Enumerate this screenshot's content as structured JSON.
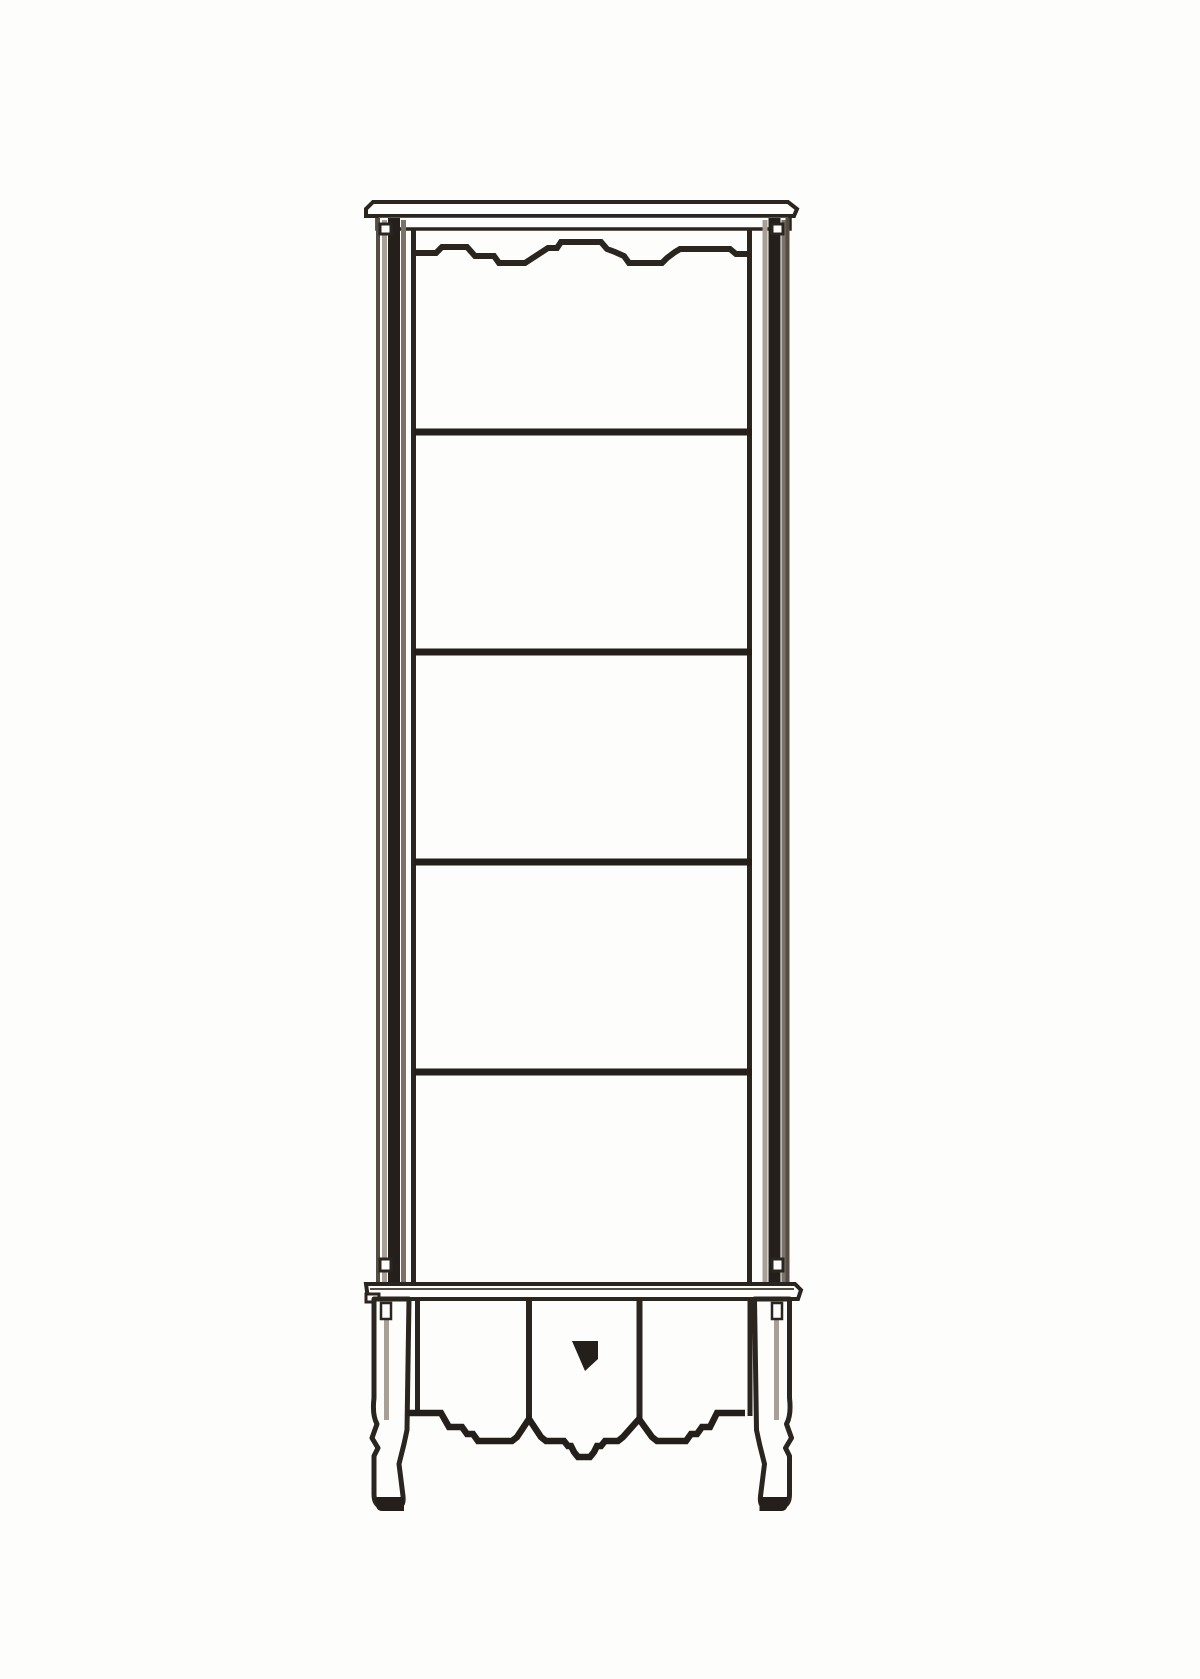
{
  "page": {
    "background": "#fdfdfc",
    "width": 1200,
    "height": 1679
  },
  "figure": {
    "kind": "black-and-white technical line drawing",
    "subject": "Tall narrow display shelf unit with carved top apron, five open shelf compartments, lower drawer apron with center keyhole, and two cabriole legs",
    "shelf_compartments": 5,
    "shelf_lines": 4,
    "drawer_panels": 3,
    "keyhole_count": 1,
    "leg_count": 2
  },
  "colors": {
    "ink_darkest": "#241f1a",
    "ink_dark": "#2b2520",
    "ink_mid": "#554c44",
    "shade_light": "#a89f97",
    "shade_mid": "#7b7269",
    "paper": "#fdfdfc"
  }
}
